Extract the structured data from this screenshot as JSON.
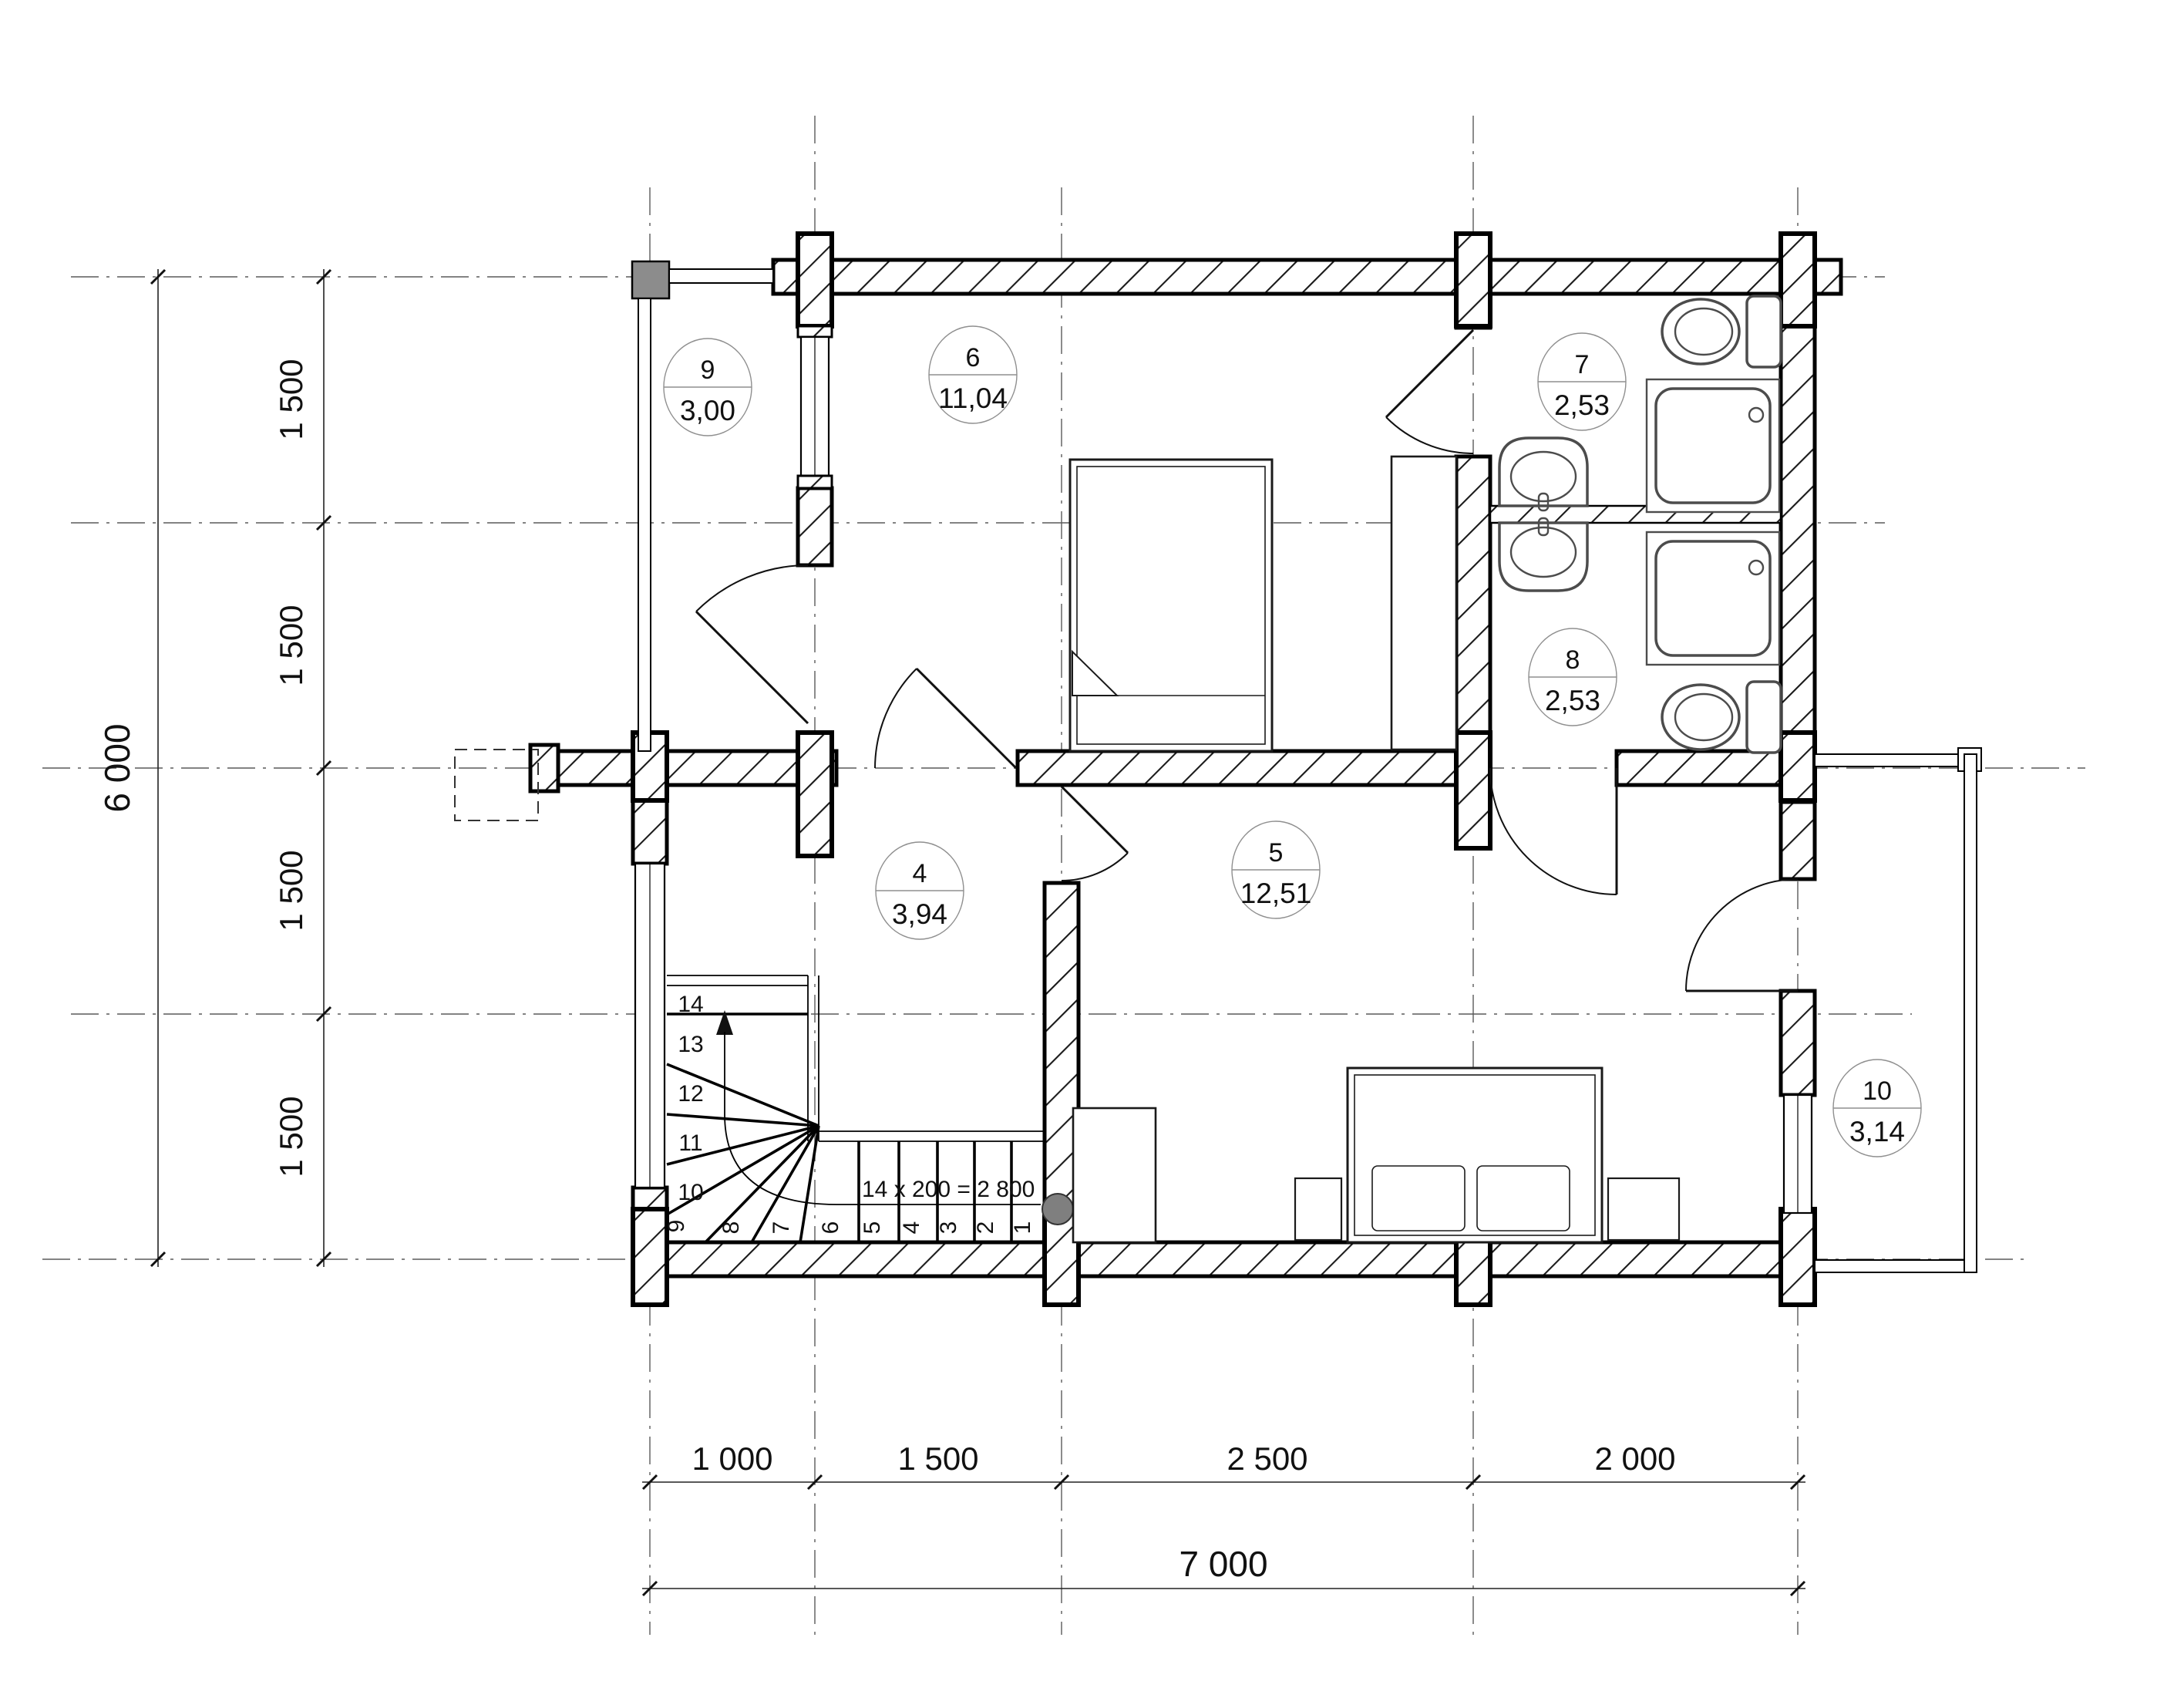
{
  "plan": {
    "rooms": [
      {
        "number": "4",
        "area": "3,94"
      },
      {
        "number": "5",
        "area": "12,51"
      },
      {
        "number": "6",
        "area": "11,04"
      },
      {
        "number": "7",
        "area": "2,53"
      },
      {
        "number": "8",
        "area": "2,53"
      },
      {
        "number": "9",
        "area": "3,00"
      },
      {
        "number": "10",
        "area": "3,14"
      }
    ],
    "stairs": {
      "formula": "14 x 200 = 2 800",
      "lower": [
        "1",
        "2",
        "3",
        "4",
        "5",
        "6",
        "7",
        "8",
        "9"
      ],
      "upper": [
        "10",
        "11",
        "12",
        "13",
        "14"
      ]
    },
    "dimensions": {
      "left_total": "6 000",
      "left_segments": [
        "1 500",
        "1 500",
        "1 500",
        "1 500"
      ],
      "bottom_segments": [
        "1 000",
        "1 500",
        "2 500",
        "2 000"
      ],
      "bottom_total": "7 000"
    },
    "colors": {
      "wall_line": "#000000",
      "grid_line": "#5a5a5a",
      "dimension_text": "#111111",
      "fixture": "#4c4c4c",
      "corner_post": "#8c8c8c",
      "newel_circle": "#7f7f7f",
      "room_circle": "#8f8f8f"
    }
  }
}
